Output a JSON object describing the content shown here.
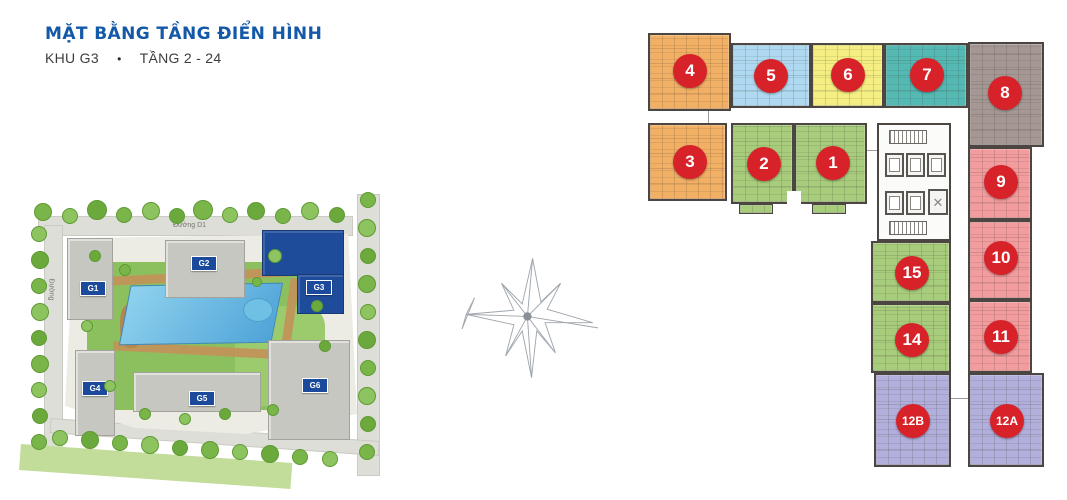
{
  "header": {
    "title": "MẶT BẰNG TẦNG ĐIỂN HÌNH",
    "area": "KHU G3",
    "bullet": "•",
    "floors": "TẦNG 2 - 24"
  },
  "site_plan": {
    "road_top_label": "Đường D1",
    "road_left_label": "Đường",
    "building_label_bg": "#1B4A9C",
    "highlight_color": "#1E4C9B",
    "buildings": [
      {
        "id": "G1",
        "label": "G1",
        "highlighted": false
      },
      {
        "id": "G2",
        "label": "G2",
        "highlighted": false
      },
      {
        "id": "G3",
        "label": "G3",
        "highlighted": true
      },
      {
        "id": "G4",
        "label": "G4",
        "highlighted": false
      },
      {
        "id": "G5",
        "label": "G5",
        "highlighted": false
      },
      {
        "id": "G6",
        "label": "G6",
        "highlighted": false
      }
    ]
  },
  "floor_plan": {
    "badge_color": "#D7222A",
    "units": [
      {
        "number": "4",
        "color": "#F2B065"
      },
      {
        "number": "5",
        "color": "#AED9F1"
      },
      {
        "number": "6",
        "color": "#F5EF83"
      },
      {
        "number": "7",
        "color": "#55B9B3"
      },
      {
        "number": "8",
        "color": "#A59894"
      },
      {
        "number": "3",
        "color": "#F2B065"
      },
      {
        "number": "2",
        "color": "#A7CC7C"
      },
      {
        "number": "1",
        "color": "#A7CC7C"
      },
      {
        "number": "9",
        "color": "#F29C9E"
      },
      {
        "number": "10",
        "color": "#F29C9E"
      },
      {
        "number": "11",
        "color": "#F29C9E"
      },
      {
        "number": "15",
        "color": "#A7CC7C"
      },
      {
        "number": "14",
        "color": "#A7CC7C"
      },
      {
        "number": "12B",
        "color": "#B1AFDB"
      },
      {
        "number": "12A",
        "color": "#B1AFDB"
      }
    ]
  }
}
